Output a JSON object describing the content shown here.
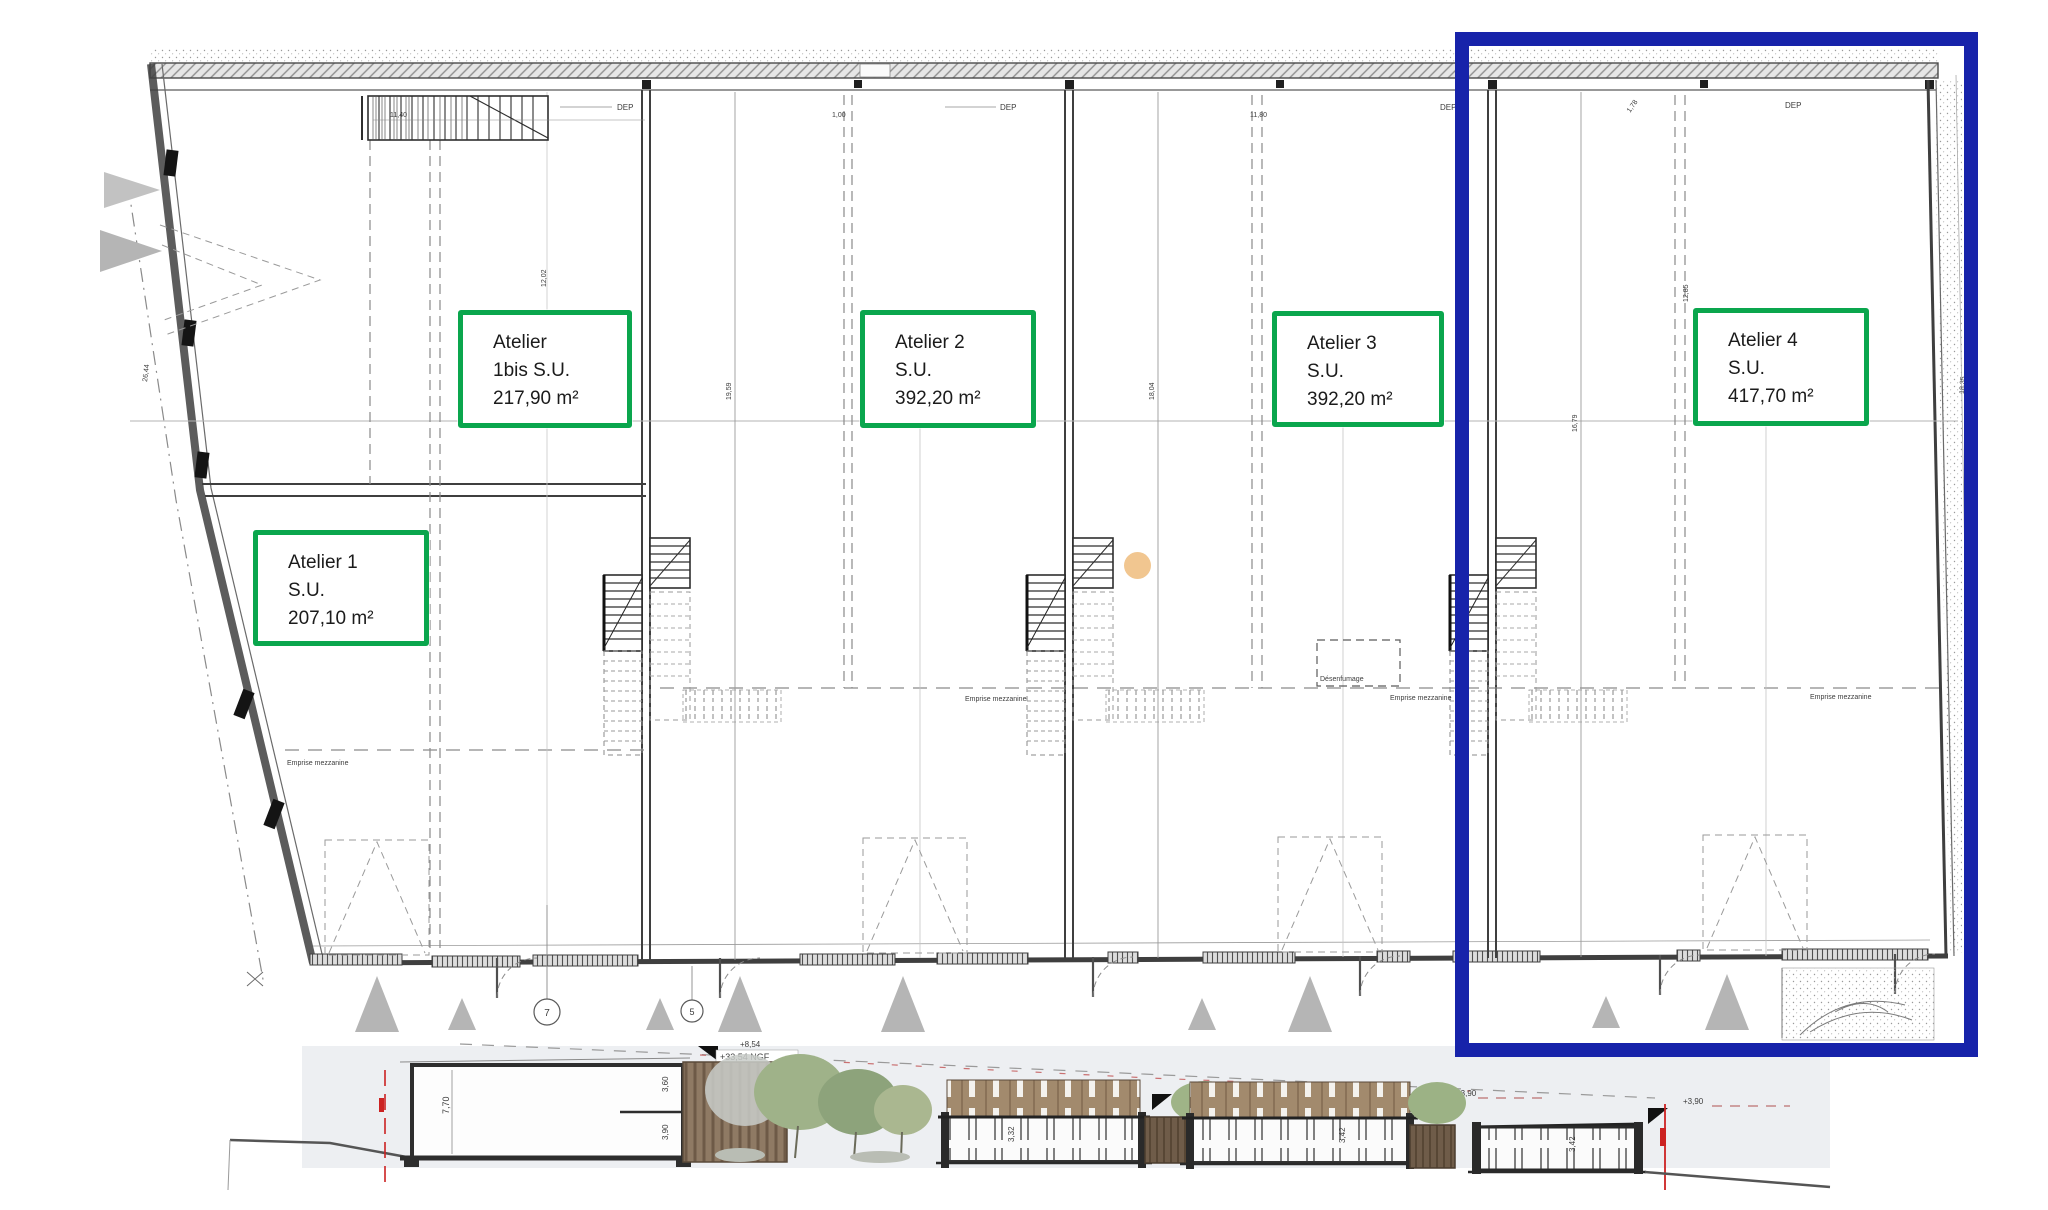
{
  "plan": {
    "units": [
      {
        "id": "atelier-1bis",
        "lines": [
          "Atelier",
          "1bis S.U.",
          "217,90 m²"
        ]
      },
      {
        "id": "atelier-2",
        "lines": [
          "Atelier 2",
          "S.U.",
          "392,20 m²"
        ]
      },
      {
        "id": "atelier-3",
        "lines": [
          "Atelier 3",
          "S.U.",
          "392,20 m²"
        ]
      },
      {
        "id": "atelier-4",
        "lines": [
          "Atelier 4",
          "S.U.",
          "417,70 m²"
        ]
      },
      {
        "id": "atelier-1",
        "lines": [
          "Atelier 1",
          "S.U.",
          "207,10 m²"
        ]
      }
    ],
    "annotations": {
      "dep": "DEP",
      "emprise_mezzanine": "Emprise mezzanine",
      "desenfumage": "Désenfumage",
      "axis_7": "7",
      "axis_5": "5",
      "dims": {
        "top_left": "11,40",
        "top_mid": "1,00",
        "top_right": "11,80",
        "top_far_right": "1,78",
        "v1": "12,02",
        "v2": "19,59",
        "v3": "18,04",
        "v4": "16,79",
        "v5": "12,85",
        "left_edge": "26,44",
        "right_edge": "18,35"
      }
    },
    "colors": {
      "highlight_box": "#1723aa",
      "unit_label_border": "#0aa64d",
      "triangle_marker": "#b5b5b5",
      "dot_marker": "#f0c38a"
    }
  },
  "elevation": {
    "levels": {
      "top": "+8,54",
      "ngf": "+33,54 NGF",
      "mid": "+4,85",
      "right_a": "+3,90",
      "right_b": "+3,90"
    },
    "dims": {
      "total_height": "7,70",
      "upper": "3,60",
      "lower": "3,90",
      "band_a": "3,32",
      "band_b": "3,42",
      "band_c": "3,42"
    }
  }
}
